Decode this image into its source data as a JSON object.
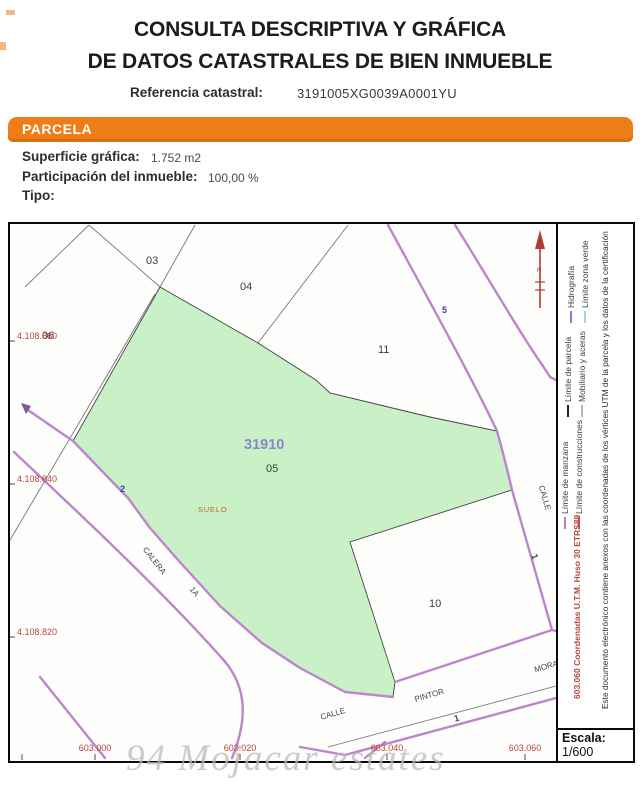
{
  "header": {
    "title_line1": "CONSULTA DESCRIPTIVA Y GRÁFICA",
    "title_line2": "DE DATOS CATASTRALES DE BIEN INMUEBLE",
    "ref_label": "Referencia catastral:",
    "ref_value": "3191005XG0039A0001YU"
  },
  "parcela": {
    "banner": "PARCELA",
    "superficie_label": "Superficie gráfica:",
    "superficie_value": "1.752 m2",
    "participacion_label": "Participación del inmueble:",
    "participacion_value": "100,00 %",
    "tipo_label": "Tipo:"
  },
  "map": {
    "parcel_id": "31910",
    "parcel_id_color": "#8787ca",
    "land_use": "SUELO",
    "north_label": "N",
    "labels": {
      "p03": "03",
      "p04": "04",
      "p06": "06",
      "p11": "11",
      "p05": "05",
      "p10": "10"
    },
    "streets": {
      "calera": "CALERA",
      "calera_num": "1A",
      "calle_bottom": "CALLE",
      "pintor": "PINTOR",
      "mora": "MORA",
      "calle_right": "CALLE"
    },
    "house_numbers": {
      "n2": "2",
      "n5": "5",
      "n1_right": "1",
      "n1_bottom": "1"
    },
    "coords_y": [
      "4.108.860",
      "4.108.840",
      "4.108.820"
    ],
    "coords_x": [
      "603.000",
      "603.020",
      "603.040",
      "603.060"
    ],
    "green_fill": "#c9f0c7",
    "road_color": "#bd85ca",
    "coord_color": "#b5453e"
  },
  "sidebar": {
    "legend": [
      {
        "label": "Límite de manzana",
        "color": "#b57fc6"
      },
      {
        "label": "Límite de construcciones",
        "color": "#c05050"
      },
      {
        "label": "Límite de parcela",
        "color": "#222222"
      },
      {
        "label": "Mobiliario y aceras",
        "color": "#b8b8b8"
      },
      {
        "label": "Hidrografía",
        "color": "#8080d0"
      },
      {
        "label": "Límite zona verde",
        "color": "#a8dca8"
      }
    ],
    "utm_text": "603.060 Coordenadas U.T.M. Huso 30 ETRS89",
    "cert_text": "Este documento electrónico contiene anexos con las coordenadas de los vértices UTM de la parcela y los datos de la certificación",
    "escala_label": "Escala:",
    "escala_value": "1/600"
  },
  "watermark": "94 Mojacar estates"
}
